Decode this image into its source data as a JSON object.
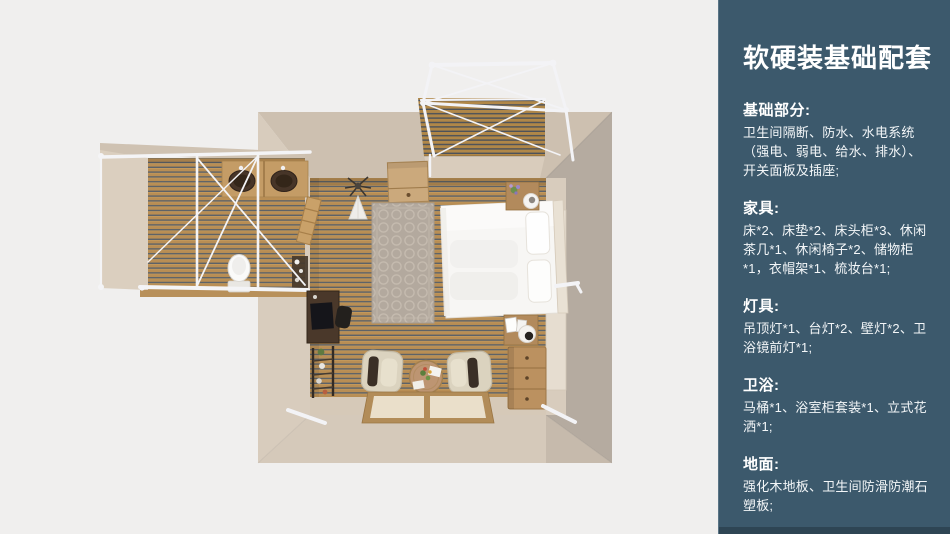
{
  "sidebar": {
    "title": "软硬装基础配套",
    "sections": [
      {
        "heading": "基础部分:",
        "body": "卫生间隔断、防水、水电系统（强电、弱电、给水、排水）、开关面板及插座;"
      },
      {
        "heading": "家具:",
        "body": "床*2、床垫*2、床头柜*3、休闲茶几*1、休闲椅子*2、储物柜*1，衣帽架*1、梳妆台*1;"
      },
      {
        "heading": "灯具:",
        "body": "吊顶灯*1、台灯*2、壁灯*2、卫浴镜前灯*1;"
      },
      {
        "heading": "卫浴:",
        "body": "马桶*1、浴室柜套装*1、立式花洒*1;"
      },
      {
        "heading": "地面:",
        "body": "强化木地板、卫生间防滑防潮石塑板;"
      }
    ]
  },
  "floorplan": {
    "view": "top-down 3d render of guest-room suite",
    "elements": [
      "pergola-frame",
      "wood-deck",
      "bedroom",
      "double-bed",
      "area-rug",
      "nightstand",
      "storage-cabinet",
      "dresser",
      "desk",
      "ladder-shelf",
      "armchairs",
      "round-tea-table",
      "tatami-mats",
      "bathroom",
      "double-vanity-sinks",
      "toilet",
      "shower-area",
      "coat-rack",
      "towel-ladder"
    ]
  },
  "colors": {
    "canvas_bg": "#F0EFEE",
    "sidebar_bg": "#3C596C",
    "sidebar_text": "#FFFFFF",
    "wall_light": "#CDC0B0",
    "wall_dark": "#B5ABA0",
    "wood_plank": "#B98E54",
    "plank_gap": "#5D6268",
    "frame_white": "#F4F4F6"
  }
}
